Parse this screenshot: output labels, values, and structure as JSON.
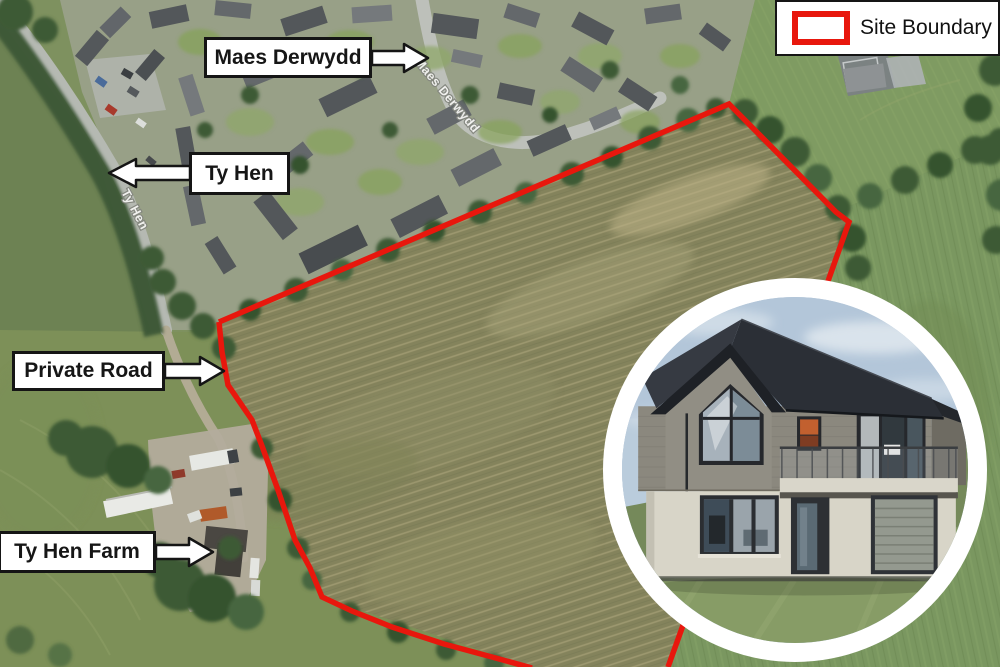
{
  "legend": {
    "label": "Site Boundary"
  },
  "callouts": [
    {
      "label": "Maes Derwydd",
      "arrow": "right"
    },
    {
      "label": "Ty Hen",
      "arrow": "left"
    },
    {
      "label": "Private Road",
      "arrow": "right"
    },
    {
      "label": "Ty Hen Farm",
      "arrow": "right"
    }
  ],
  "road_labels": [
    {
      "label": "Maes Derwydd"
    },
    {
      "label": "Ty Hen"
    }
  ],
  "colors": {
    "site_boundary": "#e8170d",
    "callout_border": "#151515",
    "legend_background": "#ffffff",
    "inset_ring": "#ffffff"
  }
}
